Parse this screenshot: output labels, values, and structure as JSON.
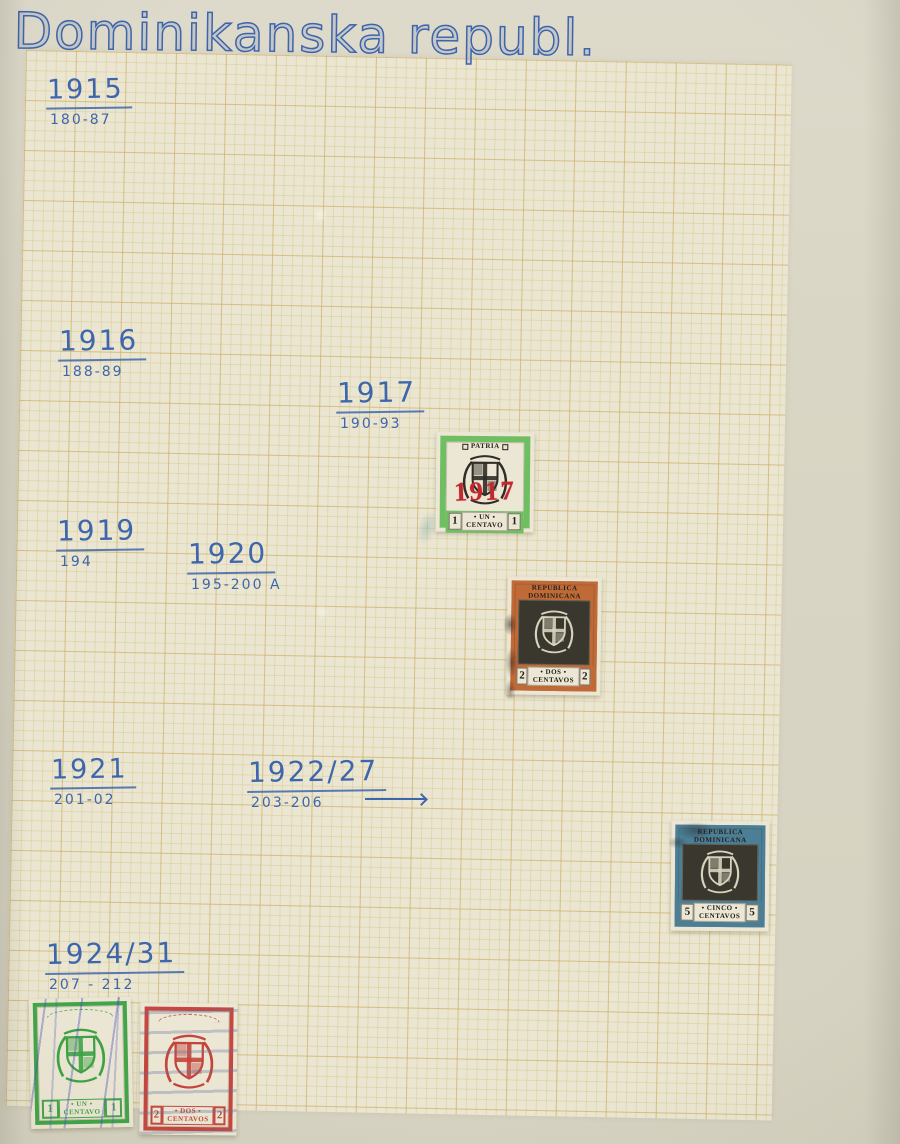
{
  "photo": {
    "title": "Dominikanska republ."
  },
  "labels": [
    {
      "year": "1915",
      "catalog": "180-87"
    },
    {
      "year": "1916",
      "catalog": "188-89"
    },
    {
      "year": "1917",
      "catalog": "190-93"
    },
    {
      "year": "1919",
      "catalog": "194"
    },
    {
      "year": "1920",
      "catalog": "195-200 A"
    },
    {
      "year": "1921",
      "catalog": "201-02"
    },
    {
      "year": "1922/27",
      "catalog": "203-206"
    },
    {
      "year": "1924/31",
      "catalog": "207 - 212"
    }
  ],
  "stamps": [
    {
      "name": "1 centavo green with red 1917 overprint",
      "top_text": "PATRIA",
      "overprint": "1917",
      "value": "1",
      "denom_line1": "• UN •",
      "denom_line2": "CENTAVO",
      "frame_color": "#6fbe62"
    },
    {
      "name": "2 centavos orange",
      "top_line1": "REPUBLICA",
      "top_line2": "DOMINICANA",
      "value": "2",
      "denom_line1": "• DOS •",
      "denom_line2": "CENTAVOS",
      "frame_color": "#c06a38"
    },
    {
      "name": "5 centavos blue",
      "top_line1": "REPUBLICA",
      "top_line2": "DOMINICANA",
      "value": "5",
      "denom_line1": "• CINCO •",
      "denom_line2": "CENTAVOS",
      "frame_color": "#4c7e95"
    },
    {
      "name": "1 centavo green 1924 series",
      "value": "1",
      "denom_line1": "• UN •",
      "denom_line2": "CENTAVO",
      "frame_color": "#43a549"
    },
    {
      "name": "2 centavos red 1924 series",
      "value": "2",
      "denom_line1": "• DOS •",
      "denom_line2": "CENTAVOS",
      "frame_color": "#c5473f"
    }
  ],
  "colors": {
    "ink_blue": "#3d64ac",
    "paper_margin": "#dad6c5",
    "graph_paper": "#eae6d1",
    "grid_line": "#c9a858",
    "overprint_red": "#c2282f"
  }
}
